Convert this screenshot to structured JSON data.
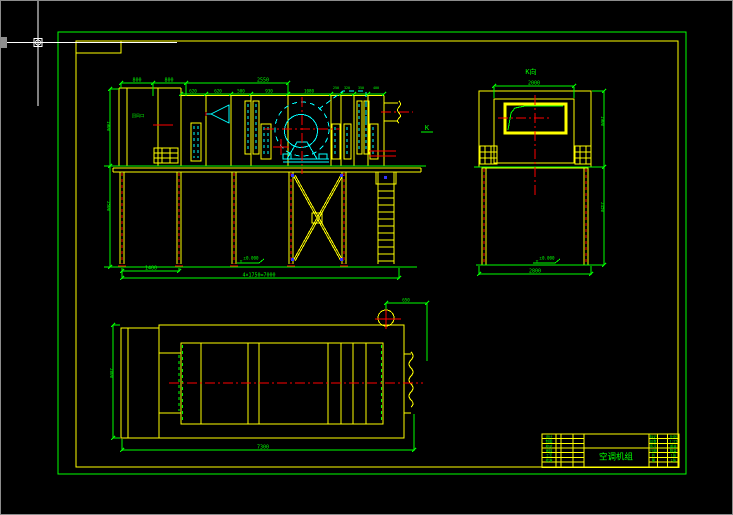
{
  "app": {
    "name": "cad-model-space",
    "background": "#000000"
  },
  "colors": {
    "frame_green": "#00ff00",
    "entity_yellow": "#ffff00",
    "detail_cyan": "#00ffff",
    "centerline_red": "#ff0000",
    "cursor_white": "#ffffff",
    "bolt_blue": "#3333ff"
  },
  "symbols": {
    "level": "▽"
  },
  "front_view": {
    "dims_top_row1": [
      "800",
      "800",
      "2550"
    ],
    "dims_top_row2": [
      "620",
      "620",
      "500",
      "930",
      "1080"
    ],
    "dims_top_row3": [
      "250",
      "320",
      "350",
      "400"
    ],
    "dim_left_upper": "1900",
    "dim_left_lower": "2500",
    "dim_bottom_left": "1400",
    "dim_bottom_total": "4×1750=7000",
    "duct_label": "K",
    "box_label": "回风口",
    "level_note": "±0.000"
  },
  "side_view": {
    "view_label": "K向",
    "dim_top": "2000",
    "dim_right_upper": "1900",
    "dim_right_lower": "2450",
    "dim_bottom": "2800",
    "level_note": "±0.000"
  },
  "plan_view": {
    "dim_left": "2800",
    "dim_bottom": "7300",
    "dim_outlet": "650"
  },
  "title_block": {
    "title": "空调机组",
    "left_rows": [
      "设计",
      "制图",
      "校对",
      "审核",
      "工艺",
      "批准"
    ],
    "right_cells": [
      [
        "标记",
        "比例"
      ],
      [
        "处数",
        "1:25"
      ],
      [
        "签字",
        "重量"
      ],
      [
        "日期",
        "数量"
      ],
      [
        "共",
        "1张"
      ],
      [
        "第",
        "1张"
      ]
    ]
  }
}
